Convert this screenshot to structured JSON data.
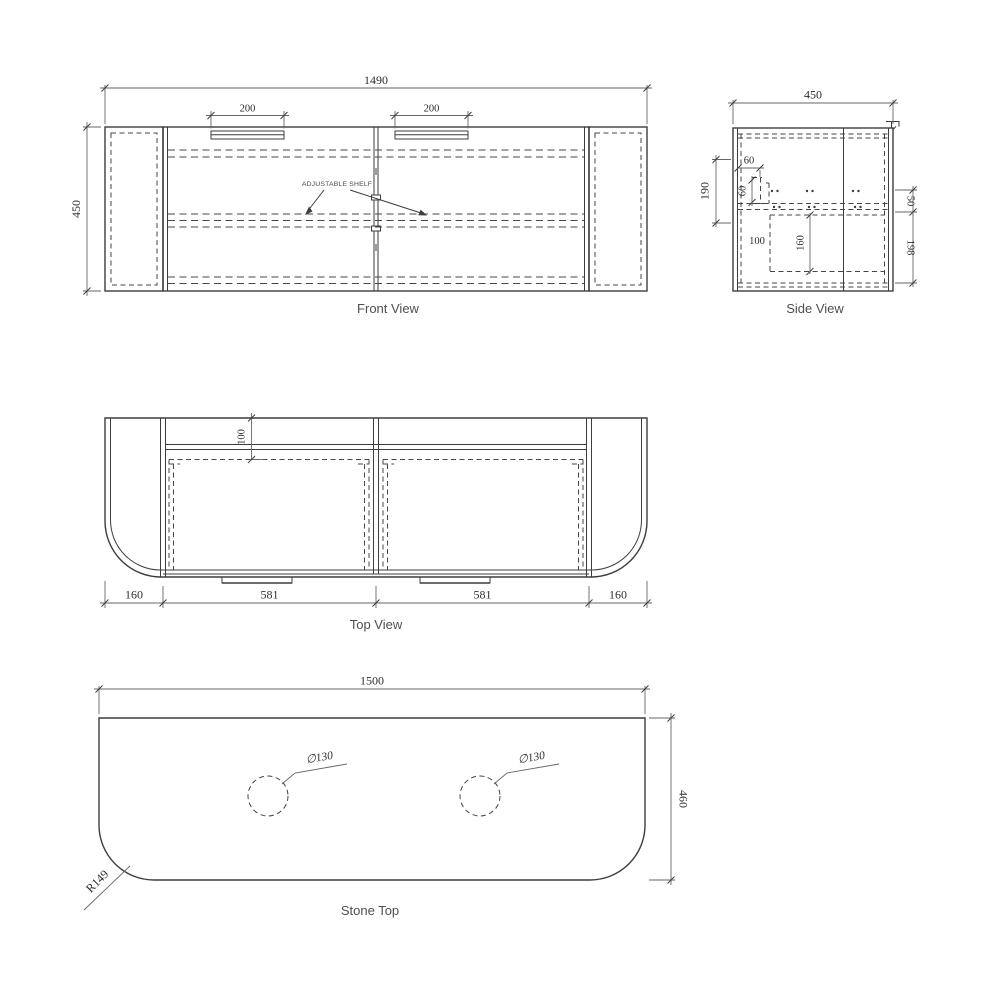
{
  "drawing": {
    "front_view": {
      "caption": "Front View",
      "width_dim": "1490",
      "height_dim": "450",
      "handle_left_dim": "200",
      "handle_right_dim": "200",
      "shelf_label": "ADJUSTABLE SHELF"
    },
    "side_view": {
      "caption": "Side View",
      "depth_dim": "450",
      "pin_column_dim": "190",
      "pin_offset_h_dim": "60",
      "pin_offset_v_dim": "60",
      "cavity_offset_dim": "100",
      "cavity_height_dim": "160",
      "rail_dim": "50",
      "bottom_clearance_dim": "198"
    },
    "top_view": {
      "caption": "Top View",
      "back_offset_dim": "100",
      "left_end_dim": "160",
      "door_left_dim": "581",
      "door_right_dim": "581",
      "right_end_dim": "160"
    },
    "stone_top": {
      "caption": "Stone Top",
      "width_dim": "1500",
      "depth_dim": "460",
      "hole_left_dim": "∅130",
      "hole_right_dim": "∅130",
      "corner_radius_dim": "R149"
    }
  }
}
